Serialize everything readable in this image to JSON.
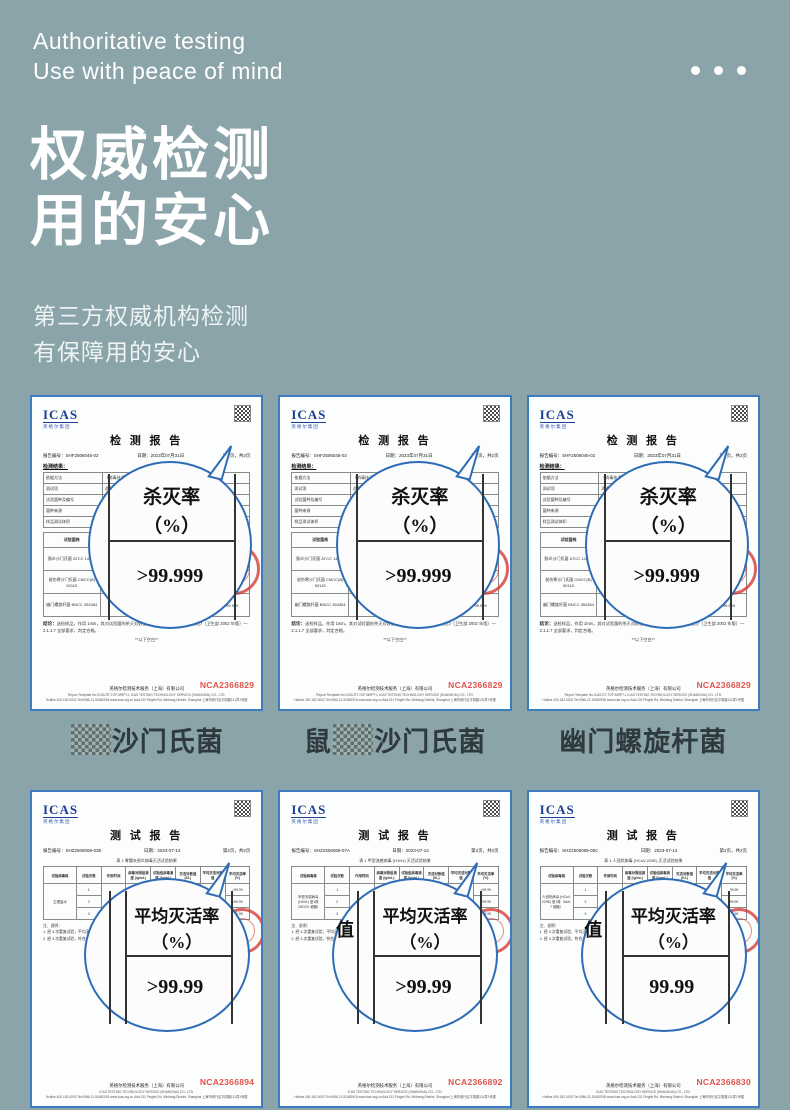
{
  "colors": {
    "background": "#8BA4AA",
    "page_border": "#3E7CC1",
    "magnifier_blue": "#2E6CB5",
    "stamp_red": "#D32F2A",
    "nca_red": "#E2524C",
    "logo_navy": "#1C3F94"
  },
  "header": {
    "en1": "Authoritative testing",
    "en2": "Use with peace of mind",
    "zh1": "权威检测",
    "zh2": "用的安心",
    "sub1": "第三方权威机构检测",
    "sub2": "有保障用的安心"
  },
  "labels": [
    {
      "pre": "",
      "censor": "██",
      "name": "沙门氏菌"
    },
    {
      "pre": "鼠",
      "censor": "██",
      "name": "沙门氏菌"
    },
    {
      "pre": "",
      "censor": "",
      "name": "幽门螺旋杆菌"
    }
  ],
  "top_certs": [
    {
      "logo": "ICAS",
      "logo_sub": "英格尔集团",
      "title": "检 测 报 告",
      "report_label": "报告编号：",
      "report_no": "SHF2506046-02",
      "date_label": "日期：",
      "date": "2023年07月31日",
      "pages": "第2页，共2页",
      "section": "检测结果：",
      "t1": [
        [
          "依据方法",
          "《消毒技术规范》（卫生部 2002年版）—2.1.1.7"
        ],
        [
          "测试项",
          "消毒剂杀灭微生物悬液定量试验"
        ],
        [
          "试验菌种及编号",
          "肠炎沙门氏菌 ATCC 14028 等"
        ],
        [
          "菌种来源",
          "标准菌种保藏中心 BNCC 354364"
        ],
        [
          "样品测试体积",
          "见报告正文"
        ]
      ],
      "t2_head": [
        "试验菌株",
        "作用浓度",
        "作用时间",
        "平均菌落数",
        "杀灭率 (%)"
      ],
      "t2_rows": [
        [
          "肠炎沙门氏菌 ATCC 14028",
          "原液",
          "1min",
          "—",
          ">99.999"
        ],
        [
          "鼠伤寒沙门氏菌 CMCC(B) 50115",
          "原液",
          "1min",
          "—",
          ">99.999"
        ],
        [
          "幽门螺旋杆菌 BNCC 354364",
          "原液",
          "1min",
          "—",
          ">99.999"
        ]
      ],
      "concl_label": "结论：",
      "concl_text": "送检样品，作用 1min，其对试验菌的杀灭对数值 >5.00，依据《消毒技术规范》（卫生部 2002 年版）—2.1.1.7 全部要求，判定合格。",
      "blank": "**以下空白**",
      "mag_l1": "杀灭率",
      "mag_l2": "（%）",
      "mag_value": ">99.999",
      "company": "英格尔检测技术服务（上海）有限公司",
      "foot1": "Report Template No.ICAS-RT-TOP-MRPT-L    ICAS TESTING TECHNOLOGY SERVICE (SHANGHAI) CO., LTD.",
      "foot2": "Hotline 400-182-0002  Tel:0086-21-51682918  www.icas.org.cn  Add:131 Pingfei Rd, Minhang District, Shanghai 上海市闵行区平阴路131弄1号楼",
      "nca": "NCA2366829"
    },
    {
      "logo": "ICAS",
      "logo_sub": "英格尔集团",
      "title": "检 测 报 告",
      "report_label": "报告编号：",
      "report_no": "SHF2506046-02",
      "date_label": "日期：",
      "date": "2023年07月31日",
      "pages": "第2页，共2页",
      "section": "检测结果：",
      "t1": [
        [
          "依据方法",
          "《消毒技术规范》（卫生部 2002年版）—2.1.1.7"
        ],
        [
          "测试项",
          "消毒剂杀灭微生物悬液定量试验"
        ],
        [
          "试验菌种及编号",
          "肠炎沙门氏菌 ATCC 14028 等"
        ],
        [
          "菌种来源",
          "标准菌种保藏中心 BNCC 354364"
        ],
        [
          "样品测试体积",
          "见报告正文"
        ]
      ],
      "t2_head": [
        "试验菌株",
        "作用浓度",
        "作用时间",
        "平均菌落数",
        "杀灭率 (%)"
      ],
      "t2_rows": [
        [
          "肠炎沙门氏菌 ATCC 14028",
          "原液",
          "1min",
          "—",
          ">99.999"
        ],
        [
          "鼠伤寒沙门氏菌 CMCC(B) 50115",
          "原液",
          "1min",
          "—",
          ">99.999"
        ],
        [
          "幽门螺旋杆菌 BNCC 354364",
          "原液",
          "1min",
          "—",
          ">99.999"
        ]
      ],
      "concl_label": "结论：",
      "concl_text": "送检样品，作用 1min，其对试验菌的杀灭对数值 >5.00，依据《消毒技术规范》（卫生部 2002 年版）—2.1.1.7 全部要求，判定合格。",
      "blank": "**以下空白**",
      "mag_l1": "杀灭率",
      "mag_l2": "（%）",
      "mag_value": ">99.999",
      "company": "英格尔检测技术服务（上海）有限公司",
      "foot1": "Report Template No.ICAS-RT-TOP-MRPT-L    ICAS TESTING TECHNOLOGY SERVICE (SHANGHAI) CO., LTD.",
      "foot2": "Hotline 400-182-0002  Tel:0086-21-51682918  www.icas.org.cn  Add:131 Pingfei Rd, Minhang District, Shanghai 上海市闵行区平阴路131弄1号楼",
      "nca": "NCA2366829"
    },
    {
      "logo": "ICAS",
      "logo_sub": "英格尔集团",
      "title": "检 测 报 告",
      "report_label": "报告编号：",
      "report_no": "SHF2506046-02",
      "date_label": "日期：",
      "date": "2023年07月31日",
      "pages": "第2页，共2页",
      "section": "检测结果：",
      "t1": [
        [
          "依据方法",
          "《消毒技术规范》（卫生部 2002年版）—2.1.1.7"
        ],
        [
          "测试项",
          "消毒剂杀灭微生物悬液定量试验"
        ],
        [
          "试验菌种及编号",
          "幽门螺旋杆菌 BNCC 354364 等"
        ],
        [
          "菌种来源",
          "标准菌种保藏中心 BNCC 354364"
        ],
        [
          "样品测试体积",
          "见报告正文"
        ]
      ],
      "t2_head": [
        "试验菌株",
        "作用浓度",
        "作用时间",
        "平均菌落数",
        "杀灭率 (%)"
      ],
      "t2_rows": [
        [
          "肠炎沙门氏菌 ATCC 14028",
          "原液",
          "1min",
          "—",
          ">99.999"
        ],
        [
          "鼠伤寒沙门氏菌 CMCC(B) 50115",
          "原液",
          "1min",
          "—",
          ">99.999"
        ],
        [
          "幽门螺旋杆菌 BNCC 354364",
          "原液",
          "1min",
          "—",
          ">99.999"
        ]
      ],
      "concl_label": "结论：",
      "concl_text": "送检样品，作用 1min，其对试验菌的杀灭对数值 >5.00，依据《消毒技术规范》（卫生部 2002 年版）—2.1.1.7 全部要求，判定合格。",
      "blank": "**以下空白**",
      "mag_l1": "杀灭率",
      "mag_l2": "（%）",
      "mag_value": ">99.999",
      "company": "英格尔检测技术服务（上海）有限公司",
      "foot1": "Report Template No.ICAS-RT-TOP-MRPT-L    ICAS TESTING TECHNOLOGY SERVICE (SHANGHAI) CO., LTD.",
      "foot2": "Hotline 400-182-0002  Tel:0086-21-51682918  www.icas.org.cn  Add:131 Pingfei Rd, Minhang District, Shanghai 上海市闵行区平阴路131弄1号楼",
      "nca": "NCA2366829"
    }
  ],
  "bottom_certs": [
    {
      "logo": "ICAS",
      "logo_sub": "英格尔集团",
      "title": "测 试 报 告",
      "report_label": "报告编号：",
      "report_no": "SHZ2506069-03E",
      "date_label": "日期：",
      "date": "2023-07-14",
      "pages": "第2页，共2页",
      "table_title": "表 1 脊髓灰质炎病毒灭活试验结果",
      "t3_head": [
        "试验病毒株",
        "试验次数",
        "作用时间",
        "病毒对照组滴度 (lg/mL)",
        "试验组病毒滴度 (lg/mL)",
        "灭活对数值 (KL)",
        "平均灭活对数值",
        "平均灭活率 (%)"
      ],
      "row_label": "生理盐水",
      "time_label": "60min",
      "avg_kl": "≥4.00",
      "r1": [
        "1",
        "7.50",
        "≤1.50",
        "4.00",
        ">99.99"
      ],
      "r2": [
        "2",
        "7.50",
        "≤1.50",
        "4.00",
        ">99.99"
      ],
      "r3": [
        "3",
        "7.50",
        "≤1.50",
        "4.00",
        ">99.99"
      ],
      "note_title": "注、说明：",
      "note1": "1. 经 3 次重复试验，平均灭活对数值 >4.00，判定对该病毒灭活有效。",
      "note2": "2. 经 3 次重复试验，符合《消毒技术规范》相关要求，平均灭活率 >99.99%。",
      "mag_left": "",
      "mag_l1": "平均灭活率",
      "mag_l2": "（%）",
      "mag_value": ">99.99",
      "company": "英格尔检测技术服务（上海）有限公司",
      "foot1": "ICAS TESTING TECHNOLOGY SERVICE (SHANGHAI) CO., LTD.",
      "foot2": "Hotline 400-182-0002  Tel:0086-21-51682918  www.icas.org.cn  Add:131 Pingfei Rd, Minhang District, Shanghai 上海市闵行区平阴路131弄1号楼",
      "nca": "NCA2366894"
    },
    {
      "logo": "ICAS",
      "logo_sub": "英格尔集团",
      "title": "测 试 报 告",
      "report_label": "报告编号：",
      "report_no": "SHZ2506069-07A",
      "date_label": "日期：",
      "date": "2023-07-14",
      "pages": "第2页，共2页",
      "table_title": "表 1 甲型流感病毒 (H1N1) 灭活试验结果",
      "t3_head": [
        "试验病毒株",
        "试验次数",
        "作用时间",
        "病毒对照组滴度 (lg/mL)",
        "试验组病毒滴度 (lg/mL)",
        "灭活对数值 (KL)",
        "平均灭活对数值",
        "平均灭活率 (%)"
      ],
      "row_label": "甲型流感病毒 (H1N1) 室1株（MDCK 细胞）",
      "time_label": "60min",
      "avg_kl": "≥4.00",
      "r1": [
        "1",
        "7.50",
        "≤1.50",
        "4.00",
        ">99.99"
      ],
      "r2": [
        "2",
        "7.50",
        "≤1.50",
        "4.00",
        ">99.99"
      ],
      "r3": [
        "3",
        "7.50",
        "≤1.50",
        "4.00",
        ">99.99"
      ],
      "note_title": "注、说明：",
      "note1": "1. 经 3 次重复试验，平均灭活对数值 >4.00，判定对该病毒灭活有效。",
      "note2": "2. 经 3 次重复试验，符合《消毒技术规范》相关要求，平均灭活率 >99.99%。",
      "mag_left": "值",
      "mag_l1": "平均灭活率",
      "mag_l2": "（%）",
      "mag_value": ">99.99",
      "company": "英格尔检测技术服务（上海）有限公司",
      "foot1": "ICAS TESTING TECHNOLOGY SERVICE (SHANGHAI) CO., LTD.",
      "foot2": "Hotline 400-182-0002  Tel:0086-21-51682918  www.icas.org.cn  Add:131 Pingfei Rd, Minhang District, Shanghai 上海市闵行区平阴路131弄1号楼",
      "nca": "NCA2366892"
    },
    {
      "logo": "ICAS",
      "logo_sub": "英格尔集团",
      "title": "测 试 报 告",
      "report_label": "报告编号：",
      "report_no": "SHZ2506069-05C",
      "date_label": "日期：",
      "date": "2023-07-14",
      "pages": "第2页，共2页",
      "table_title": "表 1 人冠状病毒 (HCoV-229E) 灭活试验结果",
      "t3_head": [
        "试验病毒株",
        "试验次数",
        "作用时间",
        "病毒对照组滴度 (lg/mL)",
        "试验组病毒滴度 (lg/mL)",
        "灭活对数值 (KL)",
        "平均灭活对数值",
        "平均灭活率 (%)"
      ],
      "row_label": "人冠状病毒 (HCoV-229E) 室1株（Huh-7 细胞）",
      "time_label": "60min",
      "avg_kl": "≥4.00",
      "r1": [
        "1",
        "7.50",
        "≤1.50",
        "4.00",
        "99.99"
      ],
      "r2": [
        "2",
        "7.50",
        "≤1.50",
        "4.00",
        "99.99"
      ],
      "r3": [
        "3",
        "7.50",
        "≤1.50",
        "4.00",
        "99.99"
      ],
      "note_title": "注、说明：",
      "note1": "1. 经 3 次重复试验，平均灭活对数值 >4.00，判定对该病毒灭活有效。",
      "note2": "2. 经 3 次重复试验，符合《消毒技术规范》相关要求，平均灭活率 >99.99%。",
      "mag_left": "值",
      "mag_l1": "平均灭活率",
      "mag_l2": "（%）",
      "mag_value": "99.99",
      "company": "英格尔检测技术服务（上海）有限公司",
      "foot1": "ICAS TESTING TECHNOLOGY SERVICE (SHANGHAI) CO., LTD.",
      "foot2": "Hotline 400-182-0002  Tel:0086-21-51682918  www.icas.org.cn  Add:131 Pingfei Rd, Minhang District, Shanghai 上海市闵行区平阴路131弄1号楼",
      "nca": "NCA2366830"
    }
  ]
}
